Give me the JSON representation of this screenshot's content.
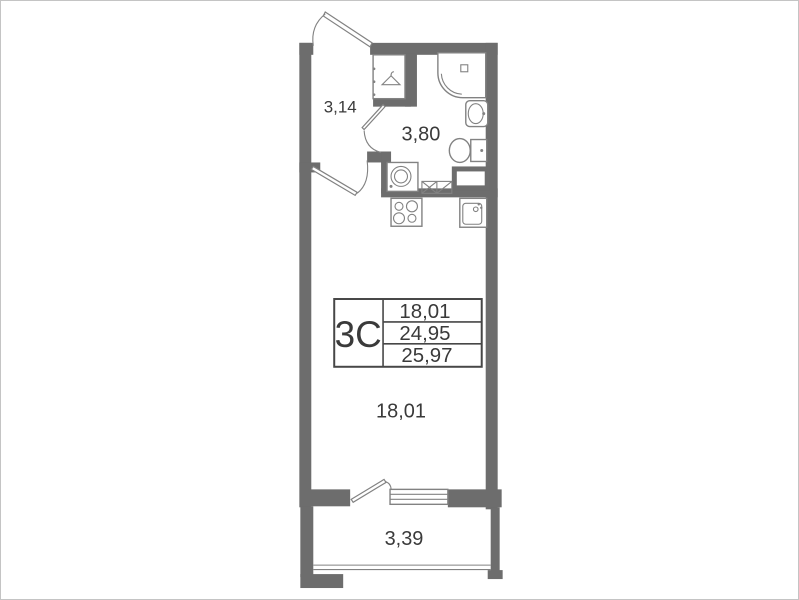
{
  "colors": {
    "wall": "#6d6d6d",
    "fixture": "#828282",
    "text": "#3a3a3a",
    "table_border": "#474747",
    "frame": "#c4c4c4",
    "bg": "#ffffff"
  },
  "plan": {
    "unit_label": "3С",
    "info_table": {
      "rows": [
        "18,01",
        "24,95",
        "25,97"
      ]
    },
    "labels": {
      "hall": "3,14",
      "bathroom": "3,80",
      "room": "18,01",
      "balcony": "3,39"
    }
  }
}
